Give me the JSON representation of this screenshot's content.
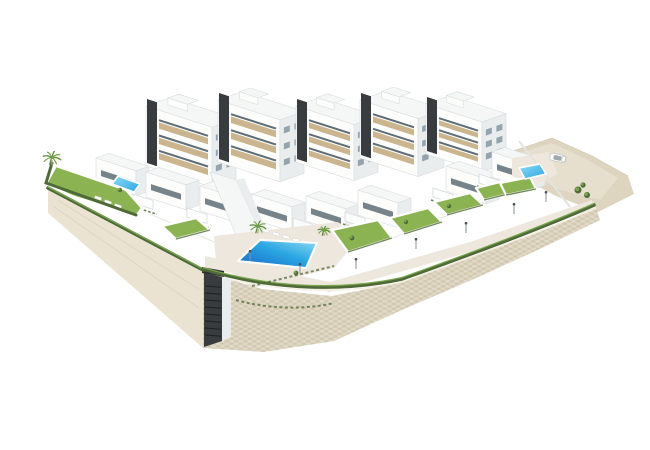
{
  "meta": {
    "title": "New-build residential complex - aerial 3D architectural rendering",
    "description": "Aerial 3D architectural rendering of a white modern hillside apartment complex with terraced private gardens, communal swimming pools, a stone retaining wall base and a sandy access road, on a plain white background",
    "background": "#ffffff"
  },
  "colors": {
    "background": "#ffffff",
    "facade": "#fdfdfc",
    "side": "#e9edee",
    "roof": "#f5f7f7",
    "roof_edge": "#d8dde0",
    "core_dark": "#383c3f",
    "tan": "#cbb58f",
    "window": "#93a4ae",
    "window_dark": "#5f6d76",
    "grass": "#8cb352",
    "grass_dark": "#74993c",
    "hedge": "#4f6a38",
    "palm": "#5c8b3d",
    "palm2": "#79a84e",
    "trunk": "#b5a485",
    "pool_deep": "#1566c8",
    "pool_mid": "#2ba6e2",
    "pool_light": "#8fdcf5",
    "deck": "#eee7de",
    "stone": "#dbd2be",
    "stone_dark": "#c6bba0",
    "stone_light": "#eae3d3",
    "wall_left": "#eae3d2",
    "sand": "#ded5c1",
    "sand_light": "#eae2d3",
    "metal": "#8a8f93"
  },
  "scene": {
    "blocks": [
      {
        "x": 146,
        "y": 106,
        "wA": 66,
        "wB": 24,
        "h": 60,
        "floors": 3,
        "core": true
      },
      {
        "x": 218,
        "y": 100,
        "wA": 62,
        "wB": 24,
        "h": 62,
        "floors": 3,
        "core": true
      },
      {
        "x": 296,
        "y": 106,
        "wA": 58,
        "wB": 24,
        "h": 56,
        "floors": 3,
        "core": true
      },
      {
        "x": 360,
        "y": 100,
        "wA": 58,
        "wB": 26,
        "h": 58,
        "floors": 3,
        "core": true
      },
      {
        "x": 426,
        "y": 104,
        "wA": 56,
        "wB": 24,
        "h": 50,
        "floors": 3,
        "core": true
      }
    ],
    "house_defaults": {
      "w": 40,
      "h": 25,
      "d": 13
    },
    "houses": [
      {
        "x": 96,
        "y": 158
      },
      {
        "x": 146,
        "y": 172
      },
      {
        "x": 200,
        "y": 186
      },
      {
        "x": 252,
        "y": 194
      },
      {
        "x": 306,
        "y": 196
      },
      {
        "x": 358,
        "y": 190
      },
      {
        "x": 446,
        "y": 166
      },
      {
        "x": 492,
        "y": 152
      }
    ],
    "lawns": [
      [
        162,
        226,
        196,
        218,
        210,
        230,
        176,
        239
      ],
      [
        332,
        230,
        378,
        220,
        392,
        238,
        348,
        252
      ],
      [
        390,
        218,
        428,
        208,
        442,
        222,
        404,
        234
      ],
      [
        434,
        202,
        470,
        193,
        483,
        205,
        447,
        215
      ],
      [
        476,
        188,
        504,
        181,
        512,
        193,
        484,
        200
      ],
      [
        500,
        183,
        530,
        177,
        536,
        189,
        506,
        195
      ]
    ],
    "pools": {
      "main": [
        238,
        261,
        260,
        240,
        317,
        243,
        306,
        268
      ],
      "left": [
        118,
        176,
        140,
        184,
        134,
        192,
        112,
        184
      ],
      "right": [
        519,
        168,
        540,
        164,
        546,
        174,
        525,
        179
      ]
    },
    "palms": [
      [
        52,
        158,
        9
      ],
      [
        258,
        227,
        8
      ],
      [
        324,
        231,
        6
      ]
    ],
    "shrubs": [
      [
        578,
        190,
        3.5
      ],
      [
        587,
        195,
        3
      ],
      [
        583,
        185,
        2.6
      ],
      [
        352,
        238,
        2.4
      ],
      [
        406,
        222,
        2.2
      ],
      [
        449,
        206,
        2.2
      ],
      [
        296,
        273,
        2.4
      ],
      [
        120,
        190,
        2.2
      ]
    ],
    "lamps": [
      [
        250,
        261
      ],
      [
        300,
        274
      ],
      [
        356,
        269
      ],
      [
        416,
        249
      ],
      [
        466,
        233
      ],
      [
        514,
        214
      ],
      [
        546,
        202
      ]
    ],
    "lounger_groups": [
      {
        "angle": 15,
        "items": [
          [
            266,
            231
          ],
          [
            276,
            234
          ],
          [
            286,
            237
          ],
          [
            296,
            240
          ]
        ]
      },
      {
        "angle": 18,
        "items": [
          [
            98,
            198
          ],
          [
            108,
            202
          ],
          [
            118,
            206
          ]
        ]
      }
    ],
    "car": {
      "x": 558,
      "y": 158,
      "angle": 12
    }
  }
}
